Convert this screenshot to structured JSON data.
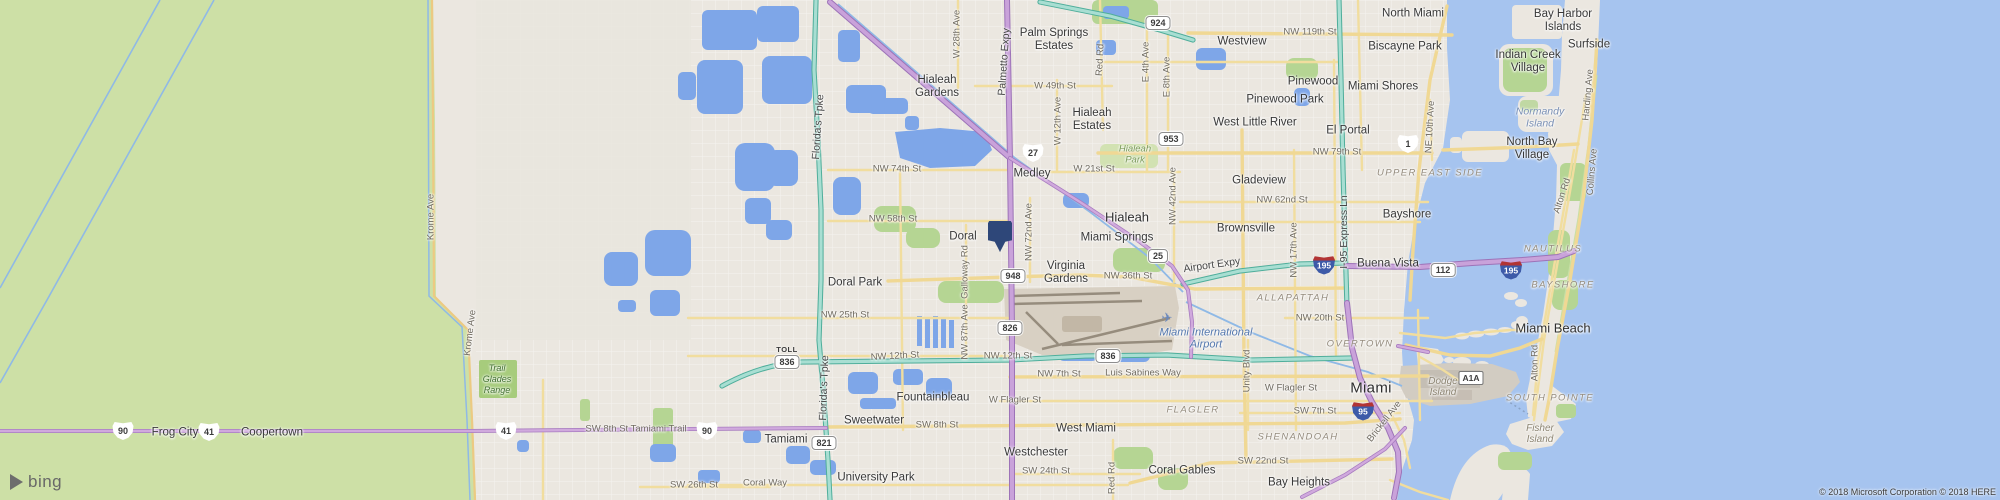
{
  "map": {
    "provider": "bing-maps",
    "logo_text": "bing",
    "toll_label": "TOLL",
    "copyright": "© 2018 Microsoft Corporation © 2018 HERE"
  },
  "marker": {
    "x": 1000,
    "y": 221
  },
  "colors": {
    "water": "#a6c4ef",
    "everglades": "#cde0a6",
    "park": "#b5d593",
    "urban": "#ebe7e0",
    "lake": "#7ea6e8",
    "expressway_purple": "#c9a2da",
    "toll_teal": "#a8ded2",
    "road_yellow": "#f1dd9e",
    "pin": "#2e4779"
  },
  "labels": [
    {
      "t": "Palm Springs\nEstates",
      "x": 1054,
      "y": 40
    },
    {
      "t": "Hialeah\nGardens",
      "x": 937,
      "y": 87
    },
    {
      "t": "Hialeah\nEstates",
      "x": 1092,
      "y": 120
    },
    {
      "t": "Medley",
      "x": 1032,
      "y": 174
    },
    {
      "t": "Doral",
      "x": 963,
      "y": 237
    },
    {
      "t": "Doral Park",
      "x": 855,
      "y": 283
    },
    {
      "t": "Virginia\nGardens",
      "x": 1066,
      "y": 273
    },
    {
      "t": "Miami Springs",
      "x": 1117,
      "y": 238
    },
    {
      "t": "Hialeah",
      "x": 1127,
      "y": 218,
      "k": "city2"
    },
    {
      "t": "Westview",
      "x": 1242,
      "y": 42
    },
    {
      "t": "North Miami",
      "x": 1413,
      "y": 14
    },
    {
      "t": "Biscayne Park",
      "x": 1405,
      "y": 47
    },
    {
      "t": "Bay Harbor\nIslands",
      "x": 1563,
      "y": 21
    },
    {
      "t": "Surfside",
      "x": 1589,
      "y": 45
    },
    {
      "t": "Indian Creek\nVillage",
      "x": 1528,
      "y": 62
    },
    {
      "t": "Pinewood",
      "x": 1313,
      "y": 82
    },
    {
      "t": "Miami Shores",
      "x": 1383,
      "y": 87
    },
    {
      "t": "Pinewood Park",
      "x": 1285,
      "y": 100
    },
    {
      "t": "West Little River",
      "x": 1255,
      "y": 123
    },
    {
      "t": "El Portal",
      "x": 1348,
      "y": 131
    },
    {
      "t": "Gladeview",
      "x": 1259,
      "y": 181
    },
    {
      "t": "Brownsville",
      "x": 1246,
      "y": 229
    },
    {
      "t": "Bayshore",
      "x": 1407,
      "y": 215
    },
    {
      "t": "Buena Vista",
      "x": 1388,
      "y": 264
    },
    {
      "t": "North Bay\nVillage",
      "x": 1532,
      "y": 149
    },
    {
      "t": "Fountainbleau",
      "x": 933,
      "y": 398
    },
    {
      "t": "Sweetwater",
      "x": 874,
      "y": 421
    },
    {
      "t": "Tamiami",
      "x": 786,
      "y": 440
    },
    {
      "t": "Westchester",
      "x": 1036,
      "y": 453
    },
    {
      "t": "University Park",
      "x": 876,
      "y": 478
    },
    {
      "t": "West Miami",
      "x": 1086,
      "y": 429
    },
    {
      "t": "Coral Gables",
      "x": 1182,
      "y": 471
    },
    {
      "t": "Bay Heights",
      "x": 1299,
      "y": 483
    },
    {
      "t": "Miami",
      "x": 1371,
      "y": 389,
      "k": "city"
    },
    {
      "t": "Miami Beach",
      "x": 1553,
      "y": 329,
      "k": "city2"
    },
    {
      "t": "Frog City",
      "x": 175,
      "y": 433
    },
    {
      "t": "Coopertown",
      "x": 272,
      "y": 433
    },
    {
      "t": "W 49th St",
      "x": 1055,
      "y": 87,
      "k": "street"
    },
    {
      "t": "NW 119th St",
      "x": 1310,
      "y": 33,
      "k": "street"
    },
    {
      "t": "NW 79th St",
      "x": 1337,
      "y": 153,
      "k": "street"
    },
    {
      "t": "NW 74th St",
      "x": 897,
      "y": 170,
      "k": "street"
    },
    {
      "t": "W 21st St",
      "x": 1094,
      "y": 170,
      "k": "street"
    },
    {
      "t": "NW 62nd St",
      "x": 1282,
      "y": 201,
      "k": "street"
    },
    {
      "t": "NW 58th St",
      "x": 893,
      "y": 220,
      "k": "street"
    },
    {
      "t": "NW 36th St",
      "x": 1128,
      "y": 277,
      "k": "street"
    },
    {
      "t": "NW 25th St",
      "x": 845,
      "y": 316,
      "k": "street"
    },
    {
      "t": "NW 20th St",
      "x": 1320,
      "y": 319,
      "k": "street"
    },
    {
      "t": "NW 12th St",
      "x": 895,
      "y": 357,
      "k": "street",
      "r": -3
    },
    {
      "t": "NW 12th St",
      "x": 1008,
      "y": 357,
      "k": "street"
    },
    {
      "t": "NW 7th St",
      "x": 1059,
      "y": 375,
      "k": "street"
    },
    {
      "t": "Luis Sabines Way",
      "x": 1143,
      "y": 374,
      "k": "street"
    },
    {
      "t": "W Flagler St",
      "x": 1015,
      "y": 401,
      "k": "street"
    },
    {
      "t": "W Flagler St",
      "x": 1291,
      "y": 389,
      "k": "street"
    },
    {
      "t": "SW 8th St",
      "x": 937,
      "y": 426,
      "k": "street"
    },
    {
      "t": "SW 7th St",
      "x": 1315,
      "y": 412,
      "k": "street"
    },
    {
      "t": "SW 22nd St",
      "x": 1263,
      "y": 462,
      "k": "street"
    },
    {
      "t": "SW 24th St",
      "x": 1046,
      "y": 472,
      "k": "street"
    },
    {
      "t": "SW 26th St",
      "x": 694,
      "y": 486,
      "k": "street"
    },
    {
      "t": "Coral Way",
      "x": 765,
      "y": 484,
      "k": "street"
    },
    {
      "t": "SW 8th St Tamiami Trail",
      "x": 636,
      "y": 430,
      "k": "street"
    },
    {
      "t": "W 28th Ave",
      "x": 958,
      "y": 34,
      "k": "street",
      "r": -90
    },
    {
      "t": "W 12th Ave",
      "x": 1059,
      "y": 121,
      "k": "street",
      "r": -90
    },
    {
      "t": "Florida's Tpke",
      "x": 819,
      "y": 127,
      "k": "roadlg",
      "r": -86
    },
    {
      "t": "Florida's Tpke",
      "x": 825,
      "y": 388,
      "k": "roadlg",
      "r": -88
    },
    {
      "t": "Palmetto Expy",
      "x": 1005,
      "y": 62,
      "k": "roadlg",
      "r": -86
    },
    {
      "t": "Krome Ave",
      "x": 432,
      "y": 217,
      "k": "street",
      "r": -90
    },
    {
      "t": "Krome Ave",
      "x": 471,
      "y": 333,
      "k": "street",
      "r": -83
    },
    {
      "t": "E 4th Ave",
      "x": 1147,
      "y": 62,
      "k": "street",
      "r": -90
    },
    {
      "t": "E 8th Ave",
      "x": 1168,
      "y": 77,
      "k": "street",
      "r": -90
    },
    {
      "t": "Red Rd",
      "x": 1101,
      "y": 60,
      "k": "street",
      "r": -87
    },
    {
      "t": "NE 10th Ave",
      "x": 1431,
      "y": 127,
      "k": "street",
      "r": -87
    },
    {
      "t": "Harding Ave",
      "x": 1589,
      "y": 95,
      "k": "street",
      "r": -85
    },
    {
      "t": "NW 42nd Ave",
      "x": 1174,
      "y": 196,
      "k": "street",
      "r": -90
    },
    {
      "t": "NW 72nd Ave",
      "x": 1030,
      "y": 232,
      "k": "street",
      "r": -90
    },
    {
      "t": "Galloway Rd",
      "x": 966,
      "y": 272,
      "k": "street",
      "r": -90
    },
    {
      "t": "NW 87th Ave",
      "x": 966,
      "y": 332,
      "k": "street",
      "r": -90
    },
    {
      "t": "NW 17th Ave",
      "x": 1295,
      "y": 250,
      "k": "street",
      "r": -90
    },
    {
      "t": "I-95 Express Ln",
      "x": 1345,
      "y": 232,
      "k": "roadlg",
      "r": -90
    },
    {
      "t": "Unity Blvd",
      "x": 1248,
      "y": 371,
      "k": "street",
      "r": -90
    },
    {
      "t": "Brickell Ave",
      "x": 1385,
      "y": 422,
      "k": "street",
      "r": -52
    },
    {
      "t": "Collins Ave",
      "x": 1593,
      "y": 172,
      "k": "street",
      "r": -85
    },
    {
      "t": "Alton Rd",
      "x": 1563,
      "y": 196,
      "k": "street",
      "r": -72
    },
    {
      "t": "Alton Rd",
      "x": 1536,
      "y": 363,
      "k": "street",
      "r": -90
    },
    {
      "t": "Airport Expy",
      "x": 1212,
      "y": 266,
      "k": "roadlg",
      "r": -8
    },
    {
      "t": "Red Rd",
      "x": 1113,
      "y": 478,
      "k": "street",
      "r": -90
    },
    {
      "t": "UPPER EAST SIDE",
      "x": 1430,
      "y": 174,
      "k": "district"
    },
    {
      "t": "NAUTILUS",
      "x": 1553,
      "y": 250,
      "k": "district"
    },
    {
      "t": "BAYSHORE",
      "x": 1563,
      "y": 286,
      "k": "district"
    },
    {
      "t": "ALLAPATTAH",
      "x": 1293,
      "y": 299,
      "k": "district"
    },
    {
      "t": "OVERTOWN",
      "x": 1360,
      "y": 345,
      "k": "district"
    },
    {
      "t": "FLAGLER",
      "x": 1193,
      "y": 411,
      "k": "district"
    },
    {
      "t": "SHENANDOAH",
      "x": 1298,
      "y": 438,
      "k": "district"
    },
    {
      "t": "SOUTH POINTE",
      "x": 1550,
      "y": 399,
      "k": "district"
    },
    {
      "t": "Normandy\nIsland",
      "x": 1540,
      "y": 118,
      "k": "waterlbl"
    },
    {
      "t": "Dodge\nIsland",
      "x": 1443,
      "y": 387,
      "k": "islandlbl"
    },
    {
      "t": "Fisher\nIsland",
      "x": 1540,
      "y": 434,
      "k": "islandlbl"
    },
    {
      "t": "Hialeah\nPark",
      "x": 1135,
      "y": 155,
      "k": "parklbl"
    },
    {
      "t": "Trail\nGlades\nRange",
      "x": 497,
      "y": 379,
      "k": "parkdk"
    },
    {
      "t": "Miami International\nAirport",
      "x": 1206,
      "y": 339,
      "k": "airportlbl"
    }
  ],
  "shields": [
    {
      "v": "924",
      "x": 1158,
      "y": 23,
      "t": "s"
    },
    {
      "v": "953",
      "x": 1171,
      "y": 139,
      "t": "s"
    },
    {
      "v": "27",
      "x": 1033,
      "y": 153,
      "t": "u"
    },
    {
      "v": "1",
      "x": 1408,
      "y": 144,
      "t": "u"
    },
    {
      "v": "25",
      "x": 1158,
      "y": 256,
      "t": "s"
    },
    {
      "v": "948",
      "x": 1013,
      "y": 276,
      "t": "s"
    },
    {
      "v": "112",
      "x": 1443,
      "y": 270,
      "t": "s"
    },
    {
      "v": "195",
      "x": 1324,
      "y": 265,
      "t": "i"
    },
    {
      "v": "195",
      "x": 1511,
      "y": 270,
      "t": "i"
    },
    {
      "v": "826",
      "x": 1010,
      "y": 328,
      "t": "s"
    },
    {
      "v": "836",
      "x": 787,
      "y": 357,
      "t": "s",
      "toll": true
    },
    {
      "v": "836",
      "x": 1108,
      "y": 356,
      "t": "s"
    },
    {
      "v": "90",
      "x": 123,
      "y": 431,
      "t": "u"
    },
    {
      "v": "41",
      "x": 209,
      "y": 432,
      "t": "u"
    },
    {
      "v": "41",
      "x": 506,
      "y": 431,
      "t": "u"
    },
    {
      "v": "90",
      "x": 707,
      "y": 431,
      "t": "u"
    },
    {
      "v": "821",
      "x": 824,
      "y": 443,
      "t": "s"
    },
    {
      "v": "95",
      "x": 1363,
      "y": 411,
      "t": "i"
    },
    {
      "v": "A1A",
      "x": 1471,
      "y": 378,
      "t": "a"
    }
  ],
  "icons": [
    {
      "n": "airplane-icon",
      "g": "✈",
      "x": 1167,
      "y": 318,
      "c": "#6a88bd",
      "s": 13
    }
  ]
}
